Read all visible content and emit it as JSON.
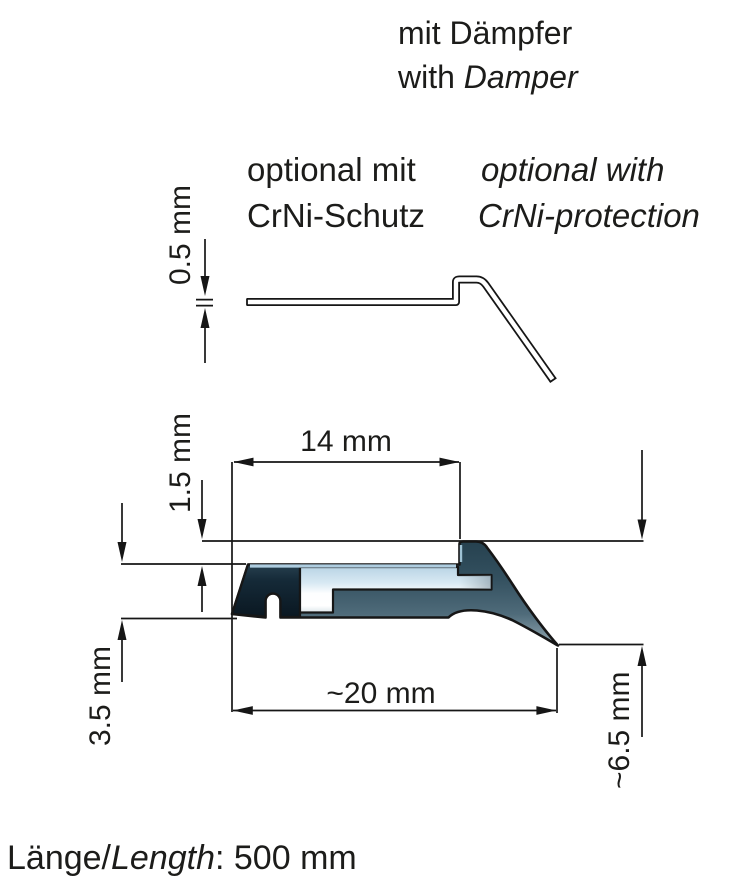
{
  "title": {
    "de": "mit Dämpfer",
    "en_prefix": "with ",
    "en_italic": "Damper"
  },
  "optional": {
    "de_line1": "optional mit",
    "de_line2": "CrNi-Schutz",
    "en_line1": "optional with",
    "en_line2": "CrNi-protection"
  },
  "dimensions": {
    "sheet_thickness": "0.5 mm",
    "flat_top_width": "14 mm",
    "lip_height": "1.5 mm",
    "body_height": "3.5 mm",
    "overall_width": "~20 mm",
    "overall_drop": "~6.5 mm"
  },
  "footer": {
    "de_prefix": "Länge/",
    "en_italic": "Length",
    "value": ": 500 mm"
  },
  "colors": {
    "outline": "#161616",
    "text": "#1c1c1a",
    "profile_dark_block": "#0d1b26",
    "profile_body": "#3e5a6b",
    "damper_glass": "#eef6fa",
    "highlight_edge": "#aecde0",
    "background": "#ffffff"
  }
}
